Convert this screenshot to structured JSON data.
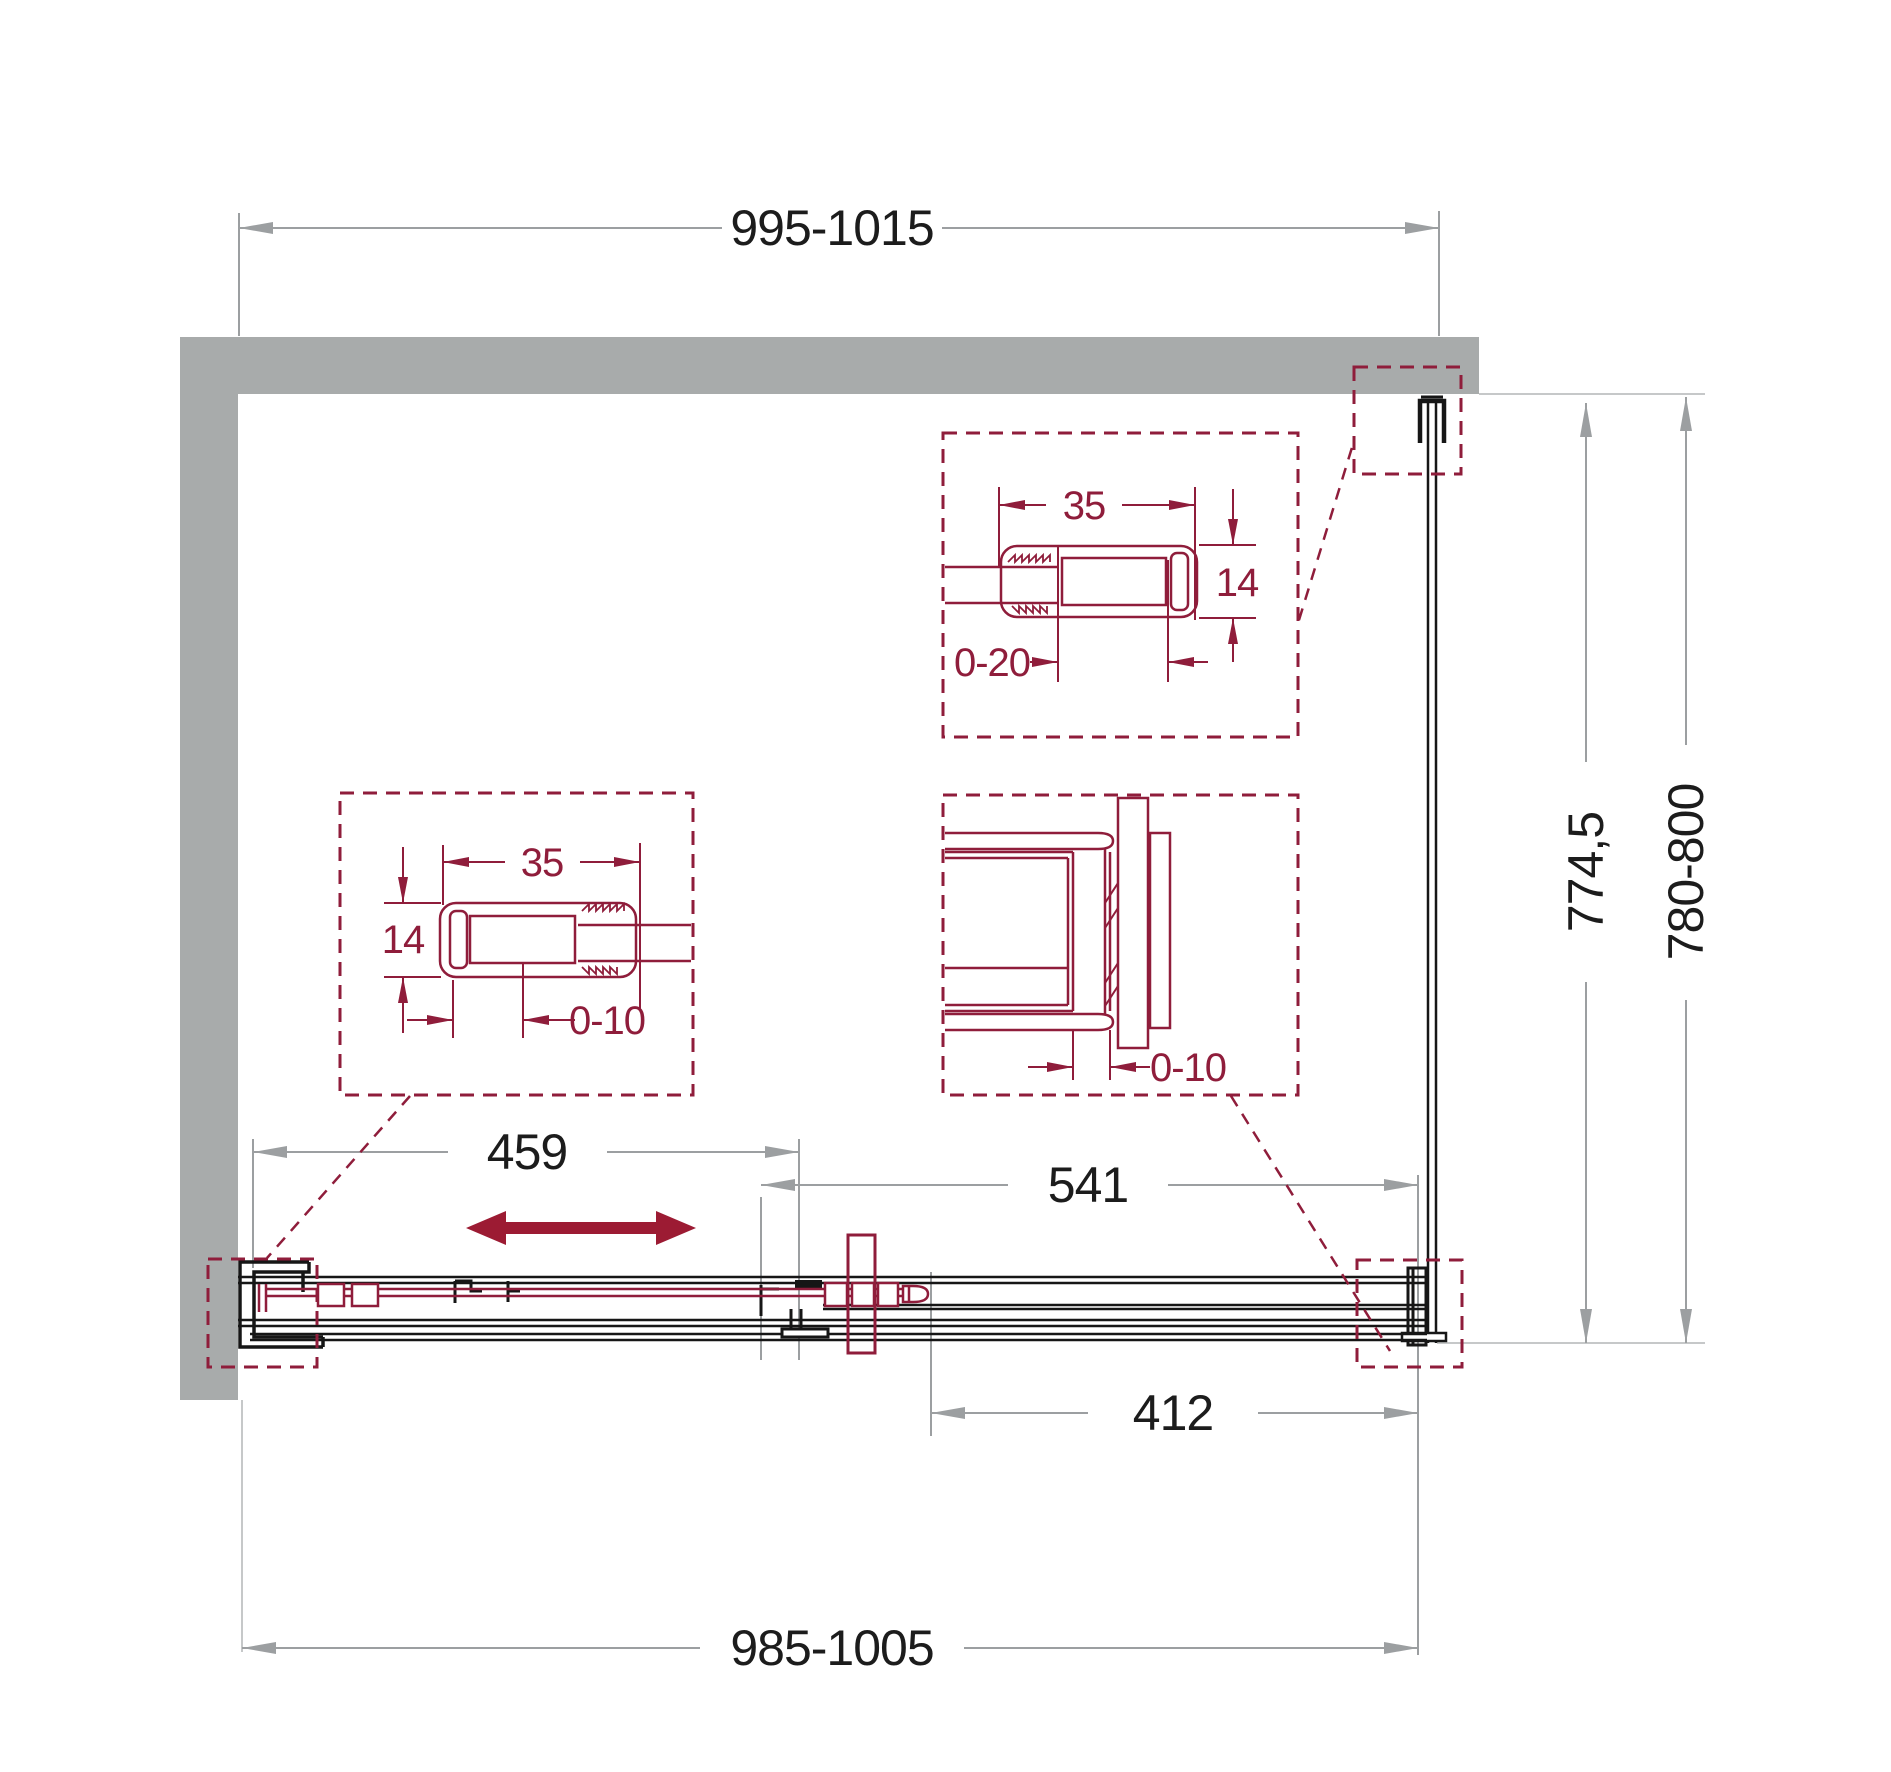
{
  "drawing": {
    "type": "shower-enclosure-installation-plan",
    "dims": {
      "top_width": "995-1015",
      "bottom_width": "985-1005",
      "door_opening": "459",
      "fixed_section": "541",
      "door_panel": "412",
      "inner_depth": "774,5",
      "depth_range": "780-800"
    },
    "detail_top_right": {
      "profile_width": "35",
      "profile_depth": "14",
      "glass_adjust": "0-20"
    },
    "detail_left": {
      "profile_width": "35",
      "profile_depth": "14",
      "glass_adjust": "0-10"
    },
    "detail_center": {
      "glass_adjust": "0-10"
    },
    "colors": {
      "accent_maroon": "#8F1D3B",
      "arrow_maroon": "#9C1B33",
      "wall_gray": "#A8ABAB",
      "dim_gray": "#9C9FA1",
      "hairline_gray": "#C6C8C9",
      "line_black": "#161616"
    }
  }
}
